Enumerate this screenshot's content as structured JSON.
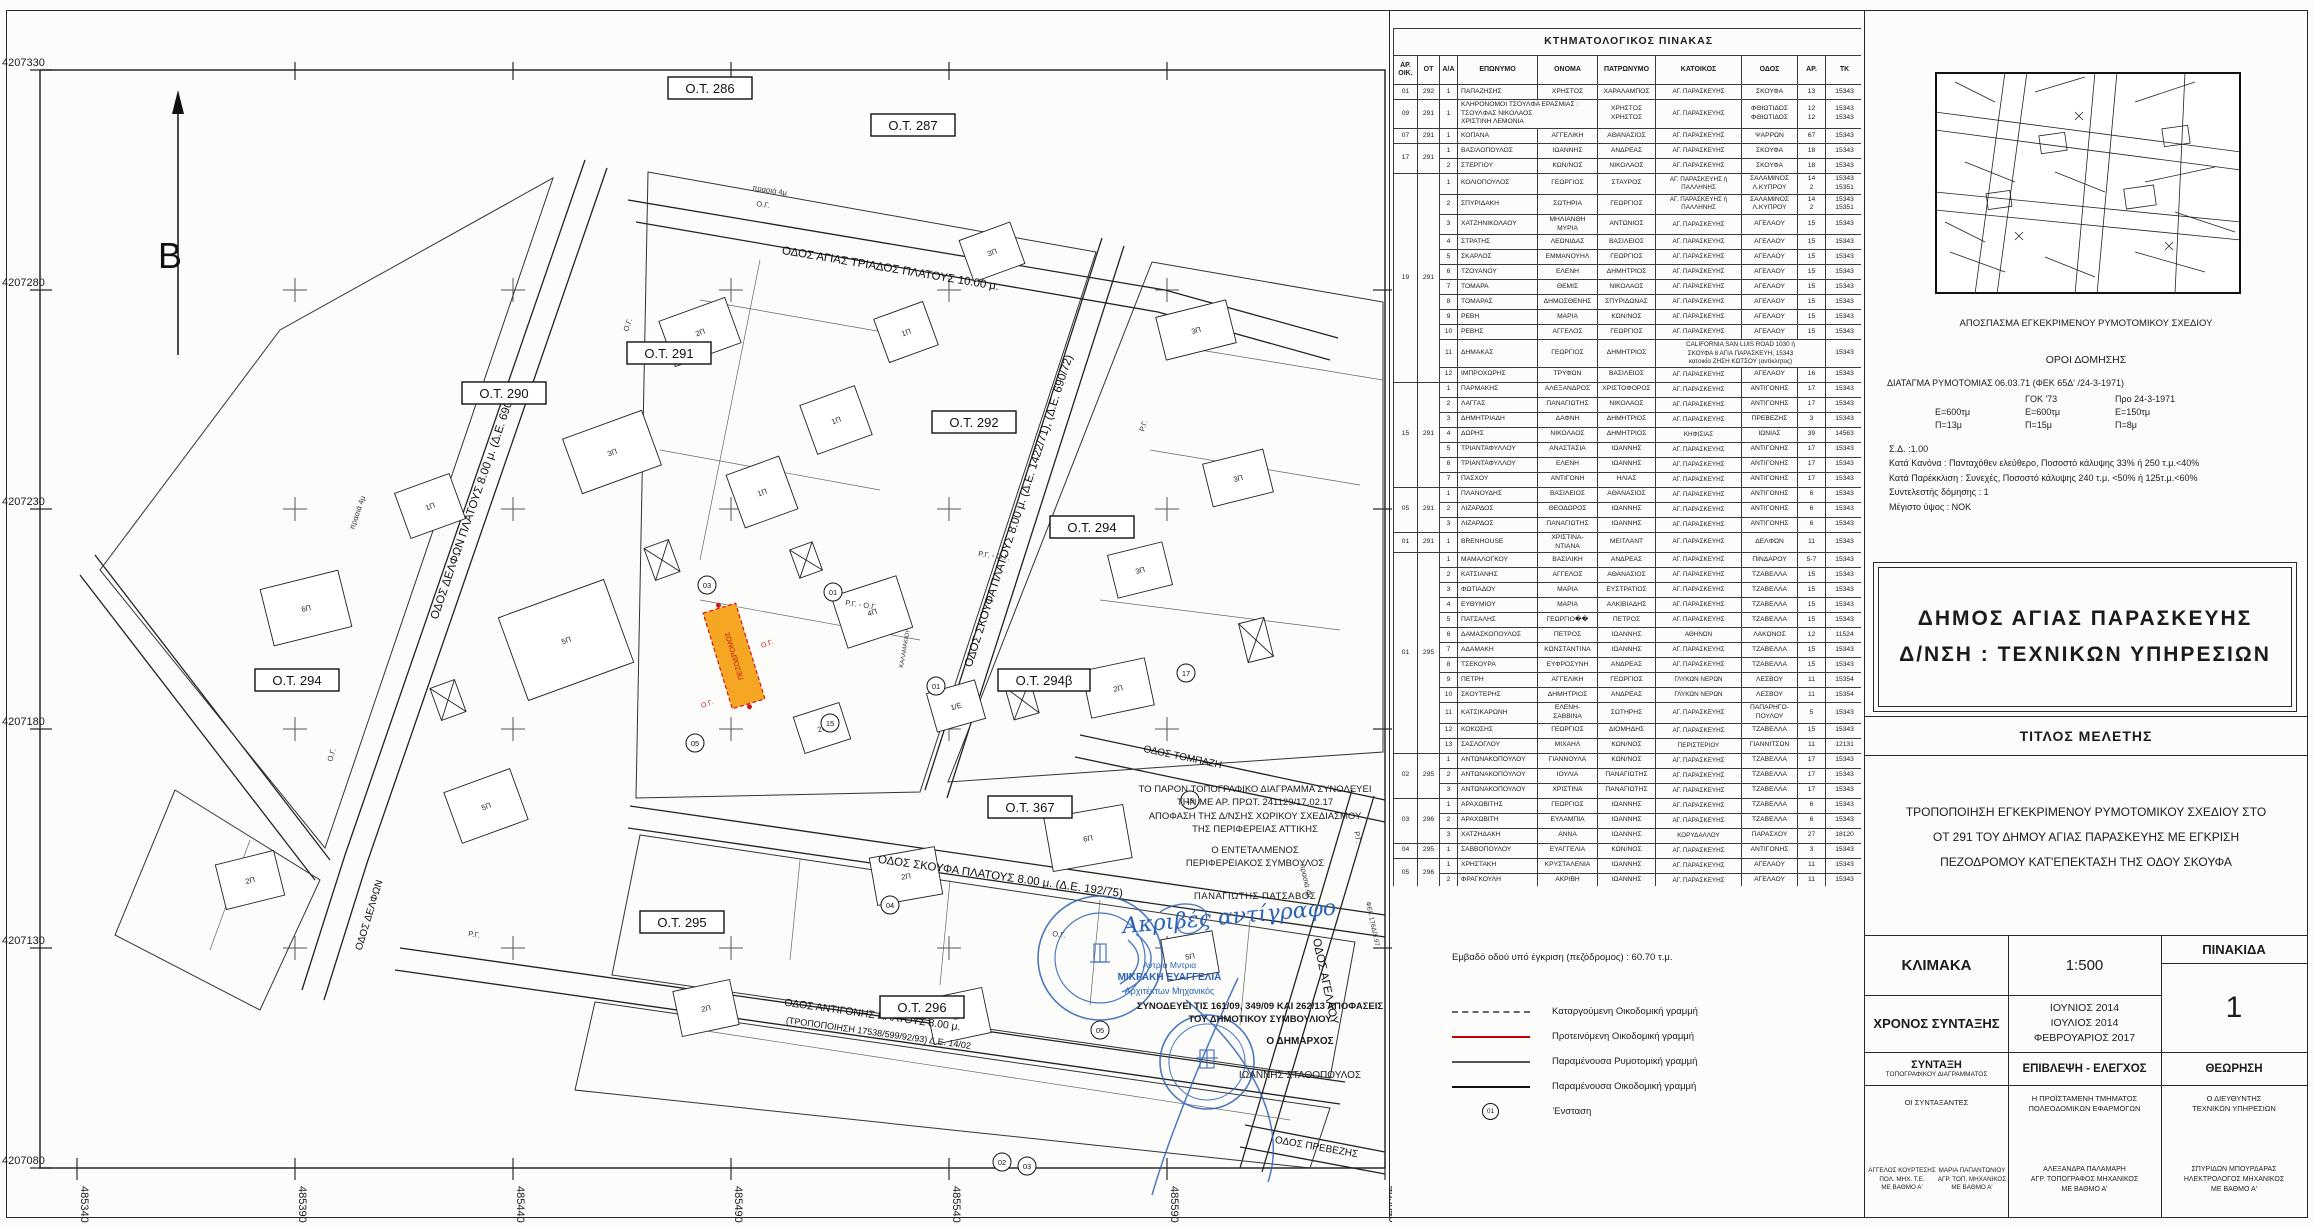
{
  "map": {
    "north_label": "Β",
    "y_ticks": [
      "4207330",
      "4207280",
      "4207230",
      "4207180",
      "4207130",
      "4207080"
    ],
    "x_ticks": [
      "485340",
      "485390",
      "485440",
      "485490",
      "485540",
      "485590",
      "485640"
    ],
    "blocks": [
      "Ο.Τ. 286",
      "Ο.Τ. 287",
      "Ο.Τ. 290",
      "Ο.Τ. 291",
      "Ο.Τ. 292",
      "Ο.Τ. 294",
      "Ο.Τ. 294β",
      "Ο.Τ. 367",
      "Ο.Τ. 294",
      "Ο.Τ. 295",
      "Ο.Τ. 296"
    ],
    "streets": [
      "ΟΔΟΣ ΑΓΙΑΣ ΤΡΙΑΔΟΣ ΠΛΑΤΟΥΣ 10.00 μ.",
      "ΟΔΟΣ ΔΕΛΦΩΝ ΠΛΑΤΟΥΣ 8.00 μ. (Δ.Ε. 690/72)",
      "ΟΔΟΣ ΣΚΟΥΦΑ ΠΛΑΤΟΥΣ 8.00 μ. (Δ.Ε. 1422/71), (Δ.Ε. 690/72)",
      "ΟΔΟΣ ΣΚΟΥΦΑ ΠΛΑΤΟΥΣ 8.00 μ. (Δ.Ε. 192/75)",
      "ΟΔΟΣ ΑΝΤΙΓΟΝΗΣ ΠΛΑΤΟΥΣ 8.00 μ.",
      "(ΤΡΟΠΟΠΟΙΗΣΗ 17538/599/92/93) Δ.Ε. 14/02",
      "ΟΔΟΣ ΑΓΕΛΑΟΥ",
      "ΟΔΟΣ ΠΡΕΒΕΖΗΣ",
      "ΟΔΟΣ ΤΟΜΠΑΖΗ",
      "ΟΔΟΣ ΔΕΛΦΩΝ"
    ],
    "pedestrian_label": "ΠΕΖΟΔΡΟΜΟΣ",
    "small": {
      "rg_og": "Ρ.Γ. - Ο.Γ.",
      "rg": "Ρ.Γ.",
      "og": "Ο.Γ.",
      "prasia": "πρασιά 4μ",
      "fek": "ΦΕΚ 176Δ/5.97",
      "kalamakiou": "ΚΑΛΑΜΑΚΙΟΥ"
    },
    "buildings": [
      "2Π",
      "3Π",
      "5Π",
      "1Π",
      "1Π",
      "1Π",
      "3Π",
      "3Π",
      "3Π",
      "3Π",
      "2Π",
      "4Π",
      "1/Ε",
      "2Π",
      "5Π",
      "6Π",
      "1Π",
      "2Π",
      "6Π",
      "2Π",
      "2Π",
      "5Π",
      "2Π"
    ],
    "objections": [
      "03",
      "01",
      "17",
      "15",
      "01",
      "05",
      "19",
      "04",
      "05",
      "02",
      "03"
    ]
  },
  "notes": {
    "line1": "ΤΟ ΠΑΡΟΝ ΤΟΠΟΓΡΑΦΙΚΟ ΔΙΑΓΡΑΜΜΑ ΣΥΝΟΔΕΥΕΙ\nΤΗΝ ΜΕ ΑΡ. ΠΡΩΤ. 241129/17.02.17\nΑΠΟΦΑΣΗ ΤΗΣ Δ/ΝΣΗΣ ΧΩΡΙΚΟΥ ΣΧΕΔΙΑΣΜΟΥ\nΤΗΣ ΠΕΡΙΦΕΡΕΙΑΣ ΑΤΤΙΚΗΣ",
    "line2": "Ο ΕΝΤΕΤΑΛΜΕΝΟΣ\nΠΕΡΙΦΕΡΕΙΑΚΟΣ ΣΥΜΒΟΥΛΟΣ",
    "name": "ΠΑΝΑΓΙΩΤΗΣ ΠΑΤΣΑΒΟΣ",
    "certified": "Ακριβές αντίγραφο",
    "architect_hand": "Αντρια Μντρια",
    "architect": "ΜΙΚΡΑΚΗ ΕΥΑΓΓΕΛΙΑ",
    "architect_title": "Αρχιτέκτων Μηχανικός",
    "council": "ΣΥΝΟΔΕΥΕΙ ΤΙΣ 161/09, 349/09 ΚΑΙ 262/13 ΑΠΟΦΑΣΕΙΣ\nΤΟΥ ΔΗΜΟΤΙΚΟΥ ΣΥΜΒΟΥΛΙΟΥ",
    "mayor_label": "Ο ΔΗΜΑΡΧΟΣ",
    "mayor": "ΙΩΑΝΝΗΣ ΣΤΑΘΟΠΟΥΛΟΣ"
  },
  "legend": {
    "area_note": "Εμβαδό οδού υπό έγκριση (πεζόδρομος) : 60.70 τ.μ.",
    "items": [
      {
        "label": "Καταργούμενη Οικοδομική γραμμή"
      },
      {
        "label": "Προτεινόμενη Οικοδομική γραμμή"
      },
      {
        "label": "Παραμένουσα Ρυμοτομική γραμμή"
      },
      {
        "label": "Παραμένουσα Οικοδομική γραμμή"
      }
    ],
    "objection_symbol": "01",
    "objection_label": "Ένσταση"
  },
  "table": {
    "title": "ΚΤΗΜΑΤΟΛΟΓΙΚΟΣ ΠΙΝΑΚΑΣ",
    "columns": [
      "ΑΡ.\nΟΙΚ.",
      "ΟΤ",
      "Α/Α",
      "ΕΠΩΝΥΜΟ",
      "ΟΝΟΜΑ",
      "ΠΑΤΡΩΝΥΜΟ",
      "ΚΑΤΟΙΚΟΣ",
      "ΟΔΟΣ",
      "ΑΡ.",
      "ΤΚ"
    ],
    "rows": [
      [
        "01",
        "292",
        "1",
        "ΠΑΠΑΖΗΣΗΣ",
        "ΧΡΗΣΤΟΣ",
        "ΧΑΡΑΛΑΜΠΟΣ",
        "ΑΓ. ΠΑΡΑΣΚΕΥΗΣ",
        "ΣΚΟΥΦΑ",
        "13",
        "15343"
      ],
      [
        "09",
        "291",
        "1",
        "ΚΛΗΡΟΝΟΜΟΙ ΤΣΟΥΛΦΑ ΕΡΑΣΜΙΑΣ :\nΤΣΟΥΛΦΑΣ ΝΙΚΟΛΑΟΣ\nΧΡΙΣΤΙΝΗ ΛΕΜΟΝΙΑ",
        "<",
        "ΧΡΗΣΤΟΣ\nΧΡΗΣΤΟΣ",
        "ΑΓ. ΠΑΡΑΣΚΕΥΗΣ",
        "ΦΘΙΩΤΙΔΟΣ\nΦΘΙΩΤΙΔΟΣ",
        "12\n12",
        "15343\n15343"
      ],
      [
        "07",
        "291",
        "1",
        "ΚΟΠΑΝΑ",
        "ΑΓΓΕΛΙΚΗ",
        "ΑΘΑΝΑΣΙΟΣ",
        "ΑΓ. ΠΑΡΑΣΚΕΥΗΣ",
        "ΨΑΡΡΩΝ",
        "67",
        "15343"
      ],
      [
        "17",
        "291",
        "1",
        "ΒΑΣΙΛΟΠΟΥΛΟΣ",
        "ΙΩΑΝΝΗΣ",
        "ΑΝΔΡΕΑΣ",
        "ΑΓ. ΠΑΡΑΣΚΕΥΗΣ",
        "ΣΚΟΥΦΑ",
        "18",
        "15343"
      ],
      [
        null,
        null,
        "2",
        "ΣΤΕΡΓΙΟΥ",
        "ΚΩΝ/ΝΟΣ",
        "ΝΙΚΟΛΑΟΣ",
        "ΑΓ. ΠΑΡΑΣΚΕΥΗΣ",
        "ΣΚΟΥΦΑ",
        "18",
        "15343"
      ],
      [
        "19",
        "291",
        "1",
        "ΚΟΛΙΟΠΟΥΛΟΣ",
        "ΓΕΩΡΓΙΟΣ",
        "ΣΤΑΥΡΟΣ",
        "ΑΓ. ΠΑΡΑΣΚΕΥΗΣ ή\nΠΑΛΛΗΝΗΣ",
        "ΣΑΛΑΜΙΝΟΣ\nΛ.ΚΥΠΡΟΥ",
        "14\n2",
        "15343\n15351"
      ],
      [
        null,
        null,
        "2",
        "ΣΠΥΡΙΔΑΚΗ",
        "ΣΩΤΗΡΙΑ",
        "ΓΕΩΡΓΙΟΣ",
        "ΑΓ. ΠΑΡΑΣΚΕΥΗΣ ή\nΠΑΛΛΗΝΗΣ",
        "ΣΑΛΑΜΙΝΟΣ\nΛ.ΚΥΠΡΟΥ",
        "14\n2",
        "15343\n15351"
      ],
      [
        null,
        null,
        "3",
        "ΧΑΤΖΗΝΙΚΟΛΑΟΥ",
        "ΜΗΛΙΑΝΘΗ\nΜΥΡΙΑ",
        "ΑΝΤΩΝΙΟΣ",
        "ΑΓ. ΠΑΡΑΣΚΕΥΗΣ",
        "ΑΓΕΛΑΟΥ",
        "15",
        "15343"
      ],
      [
        null,
        null,
        "4",
        "ΣΤΡΑΤΗΣ",
        "ΛΕΩΝΙΔΑΣ",
        "ΒΑΣΙΛΕΙΟΣ",
        "ΑΓ. ΠΑΡΑΣΚΕΥΗΣ",
        "ΑΓΕΛΑΟΥ",
        "15",
        "15343"
      ],
      [
        null,
        null,
        "5",
        "ΣΚΑΡΛΟΣ",
        "ΕΜΜΑΝΟΥΗΛ",
        "ΓΕΩΡΓΙΟΣ",
        "ΑΓ. ΠΑΡΑΣΚΕΥΗΣ",
        "ΑΓΕΛΑΟΥ",
        "15",
        "15343"
      ],
      [
        null,
        null,
        "6",
        "ΤΖΟΥΑΝΟΥ",
        "ΕΛΕΝΗ",
        "ΔΗΜΗΤΡΙΟΣ",
        "ΑΓ. ΠΑΡΑΣΚΕΥΗΣ",
        "ΑΓΕΛΑΟΥ",
        "15",
        "15343"
      ],
      [
        null,
        null,
        "7",
        "ΤΟΜΑΡΑ",
        "ΘΕΜΙΣ",
        "ΝΙΚΟΛΑΟΣ",
        "ΑΓ. ΠΑΡΑΣΚΕΥΗΣ",
        "ΑΓΕΛΑΟΥ",
        "15",
        "15343"
      ],
      [
        null,
        null,
        "8",
        "ΤΟΜΑΡΑΣ",
        "ΔΗΜΟΣΘΕΝΗΣ",
        "ΣΠΥΡΙΔΩΝΑΣ",
        "ΑΓ. ΠΑΡΑΣΚΕΥΗΣ",
        "ΑΓΕΛΑΟΥ",
        "15",
        "15343"
      ],
      [
        null,
        null,
        "9",
        "ΡΕΒΗ",
        "ΜΑΡΙΑ",
        "ΚΩΝ/ΝΟΣ",
        "ΑΓ. ΠΑΡΑΣΚΕΥΗΣ",
        "ΑΓΕΛΑΟΥ",
        "15",
        "15343"
      ],
      [
        null,
        null,
        "10",
        "ΡΕΒΗΣ",
        "ΑΓΓΕΛΟΣ",
        "ΓΕΩΡΓΙΟΣ",
        "ΑΓ. ΠΑΡΑΣΚΕΥΗΣ",
        "ΑΓΕΛΑΟΥ",
        "15",
        "15343"
      ],
      [
        null,
        null,
        "11",
        "ΔΗΜΑΚΑΣ",
        "ΓΕΩΡΓΙΟΣ",
        "ΔΗΜΗΤΡΙΟΣ",
        "CALIFORNIA   SAN LUIS ROAD   1030 ή\nΣΚΟΥΦΑ 8 ΑΓΙΑ ΠΑΡΑΣΚΕΥΗ, 15343\nκατοικία ΖΗΣΗ ΚΩΤΣΟΥ (αντίκλητος)",
        "<",
        "<",
        "15343"
      ],
      [
        null,
        null,
        "12",
        "ΙΜΠΡΟΧΩΡΗΣ",
        "ΤΡΥΦΩΝ",
        "ΒΑΣΙΛΕΙΟΣ",
        "ΑΓ. ΠΑΡΑΣΚΕΥΗΣ",
        "ΑΓΕΛΑΟΥ",
        "16",
        "15343"
      ],
      [
        "15",
        "291",
        "1",
        "ΠΑΡΜΑΚΗΣ",
        "ΑΛΕΞΑΝΔΡΟΣ",
        "ΧΡΙΣΤΟΦΟΡΟΣ",
        "ΑΓ. ΠΑΡΑΣΚΕΥΗΣ",
        "ΑΝΤΙΓΟΝΗΣ",
        "17",
        "15343"
      ],
      [
        null,
        null,
        "2",
        "ΛΑΓΓΑΣ",
        "ΠΑΝΑΓΙΩΤΗΣ",
        "ΝΙΚΟΛΑΟΣ",
        "ΑΓ. ΠΑΡΑΣΚΕΥΗΣ",
        "ΑΝΤΙΓΟΝΗΣ",
        "17",
        "15343"
      ],
      [
        null,
        null,
        "3",
        "ΔΗΜΗΤΡΙΑΔΗ",
        "ΔΑΦΝΗ",
        "ΔΗΜΗΤΡΙΟΣ",
        "ΑΓ. ΠΑΡΑΣΚΕΥΗΣ",
        "ΠΡΕΒΕΖΗΣ",
        "3",
        "15343"
      ],
      [
        null,
        null,
        "4",
        "ΔΩΡΗΣ",
        "ΝΙΚΟΛΑΟΣ",
        "ΔΗΜΗΤΡΙΟΣ",
        "ΚΗΦΙΣΙΑΣ",
        "ΙΩΝΙΑΣ",
        "39",
        "14563"
      ],
      [
        null,
        null,
        "5",
        "ΤΡΙΑΝΤΑΦΥΛΛΟΥ",
        "ΑΝΑΣΤΑΣΙΑ",
        "ΙΩΑΝΝΗΣ",
        "ΑΓ. ΠΑΡΑΣΚΕΥΗΣ",
        "ΑΝΤΙΓΟΝΗΣ",
        "17",
        "15343"
      ],
      [
        null,
        null,
        "6",
        "ΤΡΙΑΝΤΑΦΥΛΛΟΥ",
        "ΕΛΕΝΗ",
        "ΙΩΑΝΝΗΣ",
        "ΑΓ. ΠΑΡΑΣΚΕΥΗΣ",
        "ΑΝΤΙΓΟΝΗΣ",
        "17",
        "15343"
      ],
      [
        null,
        null,
        "7",
        "ΠΑΣΧΟΥ",
        "ΑΝΤΙΓΟΝΗ",
        "ΗΛΙΑΣ",
        "ΑΓ. ΠΑΡΑΣΚΕΥΗΣ",
        "ΑΝΤΙΓΟΝΗΣ",
        "17",
        "15343"
      ],
      [
        "05",
        "291",
        "1",
        "ΠΛΑΝΟΥΔΗΣ",
        "ΒΑΣΙΛΕΙΟΣ",
        "ΑΘΑΝΑΣΙΟΣ",
        "ΑΓ. ΠΑΡΑΣΚΕΥΗΣ",
        "ΑΝΤΙΓΟΝΗΣ",
        "6",
        "15343"
      ],
      [
        null,
        null,
        "2",
        "ΛΙΖΑΡΔΟΣ",
        "ΘΕΟΔΩΡΟΣ",
        "ΙΩΑΝΝΗΣ",
        "ΑΓ. ΠΑΡΑΣΚΕΥΗΣ",
        "ΑΝΤΙΓΟΝΗΣ",
        "6",
        "15343"
      ],
      [
        null,
        null,
        "3",
        "ΛΙΖΑΡΔΟΣ",
        "ΠΑΝΑΓΙΩΤΗΣ",
        "ΙΩΑΝΝΗΣ",
        "ΑΓ. ΠΑΡΑΣΚΕΥΗΣ",
        "ΑΝΤΙΓΟΝΗΣ",
        "6",
        "15343"
      ],
      [
        "01",
        "291",
        "1",
        "BRENHOUSE",
        "ΧΡΙΣΤΙΝΑ-ΝΤΙΑΝΑ",
        "ΜΕΙΤΛΑΝΤ",
        "ΑΓ. ΠΑΡΑΣΚΕΥΗΣ",
        "ΔΕΛΦΩΝ",
        "11",
        "15343"
      ],
      [
        "01",
        "295",
        "1",
        "ΜΑΜΑΛΟΓΚΟΥ",
        "ΒΑΣΙΛΙΚΗ",
        "ΑΝΔΡΕΑΣ",
        "ΑΓ. ΠΑΡΑΣΚΕΥΗΣ",
        "ΠΙΝΔΑΡΟΥ",
        "5-7",
        "15343"
      ],
      [
        null,
        null,
        "2",
        "ΚΑΤΣΙΑΝΗΣ",
        "ΑΓΓΕΛΟΣ",
        "ΑΘΑΝΑΣΙΟΣ",
        "ΑΓ. ΠΑΡΑΣΚΕΥΗΣ",
        "ΤΖΑΒΕΛΛΑ",
        "15",
        "15343"
      ],
      [
        null,
        null,
        "3",
        "ΦΩΤΙΑΔΟΥ",
        "ΜΑΡΙΑ",
        "ΕΥΣΤΡΑΤΙΟΣ",
        "ΑΓ. ΠΑΡΑΣΚΕΥΗΣ",
        "ΤΖΑΒΕΛΛΑ",
        "15",
        "15343"
      ],
      [
        null,
        null,
        "4",
        "ΕΥΘΥΜΙΟΥ",
        "ΜΑΡΙΑ",
        "ΑΛΚΙΒΙΑΔΗΣ",
        "ΑΓ. ΠΑΡΑΣΚΕΥΗΣ",
        "ΤΖΑΒΕΛΛΑ",
        "15",
        "15343"
      ],
      [
        null,
        null,
        "5",
        "ΠΑΤΣΑΛΗΣ",
        "ΓΕΩΡΓΙΟ��",
        "ΠΕΤΡΟΣ",
        "ΑΓ. ΠΑΡΑΣΚΕΥΗΣ",
        "ΤΖΑΒΕΛΛΑ",
        "15",
        "15343"
      ],
      [
        null,
        null,
        "6",
        "ΔΑΜΑΣΚΟΠΟΥΛΟΣ",
        "ΠΕΤΡΟΣ",
        "ΙΩΑΝΝΗΣ",
        "ΑΘΗΝΩΝ",
        "ΛΑΚΩΝΟΣ",
        "12",
        "11524"
      ],
      [
        null,
        null,
        "7",
        "ΑΔΑΜΑΚΗ",
        "ΚΩΝΣΤΑΝΤΙΝΑ",
        "ΙΩΑΝΝΗΣ",
        "ΑΓ. ΠΑΡΑΣΚΕΥΗΣ",
        "ΤΖΑΒΕΛΛΑ",
        "15",
        "15343"
      ],
      [
        null,
        null,
        "8",
        "ΤΣΕΚΟΥΡΑ",
        "ΕΥΦΡΟΣΥΝΗ",
        "ΑΝΔΡΕΑΣ",
        "ΑΓ. ΠΑΡΑΣΚΕΥΗΣ",
        "ΤΖΑΒΕΛΛΑ",
        "15",
        "15343"
      ],
      [
        null,
        null,
        "9",
        "ΠΕΤΡΗ",
        "ΑΓΓΕΛΙΚΗ",
        "ΓΕΩΡΓΙΟΣ",
        "ΓΛΥΚΩΝ ΝΕΡΩΝ",
        "ΛΕΣΒΟΥ",
        "11",
        "15354"
      ],
      [
        null,
        null,
        "10",
        "ΣΚΟΥΤΕΡΗΣ",
        "ΔΗΜΗΤΡΙΟΣ",
        "ΑΝΔΡΕΑΣ",
        "ΓΛΥΚΩΝ ΝΕΡΩΝ",
        "ΛΕΣΒΟΥ",
        "11",
        "15354"
      ],
      [
        null,
        null,
        "11",
        "ΚΑΤΣΙΚΑΡΩΝΗ",
        "ΕΛΕΝΗ-\nΣΑΒΒΙΝΑ",
        "ΣΩΤΗΡΗΣ",
        "ΑΓ. ΠΑΡΑΣΚΕΥΗΣ",
        "ΠΑΠΑΡΗΓΟ-\nΠΟΥΛΟΥ",
        "5",
        "15343"
      ],
      [
        null,
        null,
        "12",
        "ΚΟΚΟΣΗΣ",
        "ΓΕΩΡΓΙΟΣ",
        "ΔΙΟΜΗΔΗΣ",
        "ΑΓ. ΠΑΡΑΣΚΕΥΗΣ",
        "ΤΖΑΒΕΛΛΑ",
        "15",
        "15343"
      ],
      [
        null,
        null,
        "13",
        "ΣΑΣΛΟΓΛΟΥ",
        "ΜΙΧΑΗΛ",
        "ΚΩΝ/ΝΟΣ",
        "ΠΕΡΙΣΤΕΡΙΟΥ",
        "ΓΙΑΝΝΙΤΣΩΝ",
        "11",
        "12131"
      ],
      [
        "02",
        "295",
        "1",
        "ΑΝΤΩΝΑΚΟΠΟΥΛΟΥ",
        "ΓΙΑΝΝΟΥΛΑ",
        "ΚΩΝ/ΝΟΣ",
        "ΑΓ. ΠΑΡΑΣΚΕΥΗΣ",
        "ΤΖΑΒΕΛΛΑ",
        "17",
        "15343"
      ],
      [
        null,
        null,
        "2",
        "ΑΝΤΩΝΑΚΟΠΟΥΛΟΥ",
        "ΙΟΥΛΙΑ",
        "ΠΑΝΑΓΙΩΤΗΣ",
        "ΑΓ. ΠΑΡΑΣΚΕΥΗΣ",
        "ΤΖΑΒΕΛΛΑ",
        "17",
        "15343"
      ],
      [
        null,
        null,
        "3",
        "ΑΝΤΩΝΑΚΟΠΟΥΛΟΥ",
        "ΧΡΙΣΤΙΝΑ",
        "ΠΑΝΑΓΙΩΤΗΣ",
        "ΑΓ. ΠΑΡΑΣΚΕΥΗΣ",
        "ΤΖΑΒΕΛΛΑ",
        "17",
        "15343"
      ],
      [
        "03",
        "296",
        "1",
        "ΑΡΑΧΩΒΙΤΗΣ",
        "ΓΕΩΡΓΙΟΣ",
        "ΙΩΑΝΝΗΣ",
        "ΑΓ. ΠΑΡΑΣΚΕΥΗΣ",
        "ΤΖΑΒΕΛΛΑ",
        "6",
        "15343"
      ],
      [
        null,
        null,
        "2",
        "ΑΡΑΧΩΒΙΤΗ",
        "ΕΥΛΑΜΠΙΑ",
        "ΙΩΑΝΝΗΣ",
        "ΑΓ. ΠΑΡΑΣΚΕΥΗΣ",
        "ΤΖΑΒΕΛΛΑ",
        "6",
        "15343"
      ],
      [
        null,
        null,
        "3",
        "ΧΑΤΖΗΔΑΚΗ",
        "ΑΝΝΑ",
        "ΙΩΑΝΝΗΣ",
        "ΚΟΡΥΔΑΛΛΟΥ",
        "ΠΑΡΑΣΧΟΥ",
        "27",
        "18120"
      ],
      [
        "04",
        "295",
        "1",
        "ΣΑΒΒΟΠΟΥΛΟΥ",
        "ΕΥΑΓΓΕΛΙΑ",
        "ΚΩΝ/ΝΟΣ",
        "ΑΓ. ΠΑΡΑΣΚΕΥΗΣ",
        "ΑΝΤΙΓΟΝΗΣ",
        "3",
        "15343"
      ],
      [
        "05",
        "296",
        "1",
        "ΧΡΗΣΤΑΚΗ",
        "ΚΡΥΣΤΑΛΕΝΙΑ",
        "ΙΩΑΝΝΗΣ",
        "ΑΓ. ΠΑΡΑΣΚΕΥΗΣ",
        "ΑΓΕΛΑΟΥ",
        "11",
        "15343"
      ],
      [
        null,
        null,
        "2",
        "ΦΡΑΓΚΟΥΛΗ",
        "ΑΚΡΙΒΗ",
        "ΙΩΑΝΝΗΣ",
        "ΑΓ. ΠΑΡΑΣΚΕΥΗΣ",
        "ΑΓΕΛΑΟΥ",
        "11",
        "15343"
      ]
    ]
  },
  "panel": {
    "excerpt_caption": "ΑΠΟΣΠΑΣΜΑ ΕΓΚΕΚΡΙΜΕΝΟΥ ΡΥΜΟΤΟΜΙΚΟΥ ΣΧΕΔΙΟΥ",
    "terms_title": "ΟΡΟΙ ΔΟΜΗΣΗΣ",
    "decree": "ΔΙΑΤΑΓΜΑ ΡΥΜΟΤΟΜΙΑΣ 06.03.71 (ΦΕΚ 65Δ' /24-3-1971)",
    "gok_header": "ΓΟΚ '73",
    "pre_header": "Προ 24-3-1971",
    "e_row": [
      "Ε=600τμ",
      "Ε=600τμ",
      "Ε=150τμ"
    ],
    "p_row": [
      "Π=13μ",
      "Π=15μ",
      "Π=8μ"
    ],
    "sd": "Σ.Δ. :1.00",
    "rule": "Κατά Κανόνα : Πανταχόθεν ελεύθερο, Ποσοστό κάλυψης 33% ή 250 τ.μ.<40%",
    "exception": "Κατά Παρέκκλιση : Συνεχές, Ποσοστό κάλυψης 240 τ.μ. <50% ή 125τ.μ.<60%",
    "coefficient": "Συντελεστής δόμησης : 1",
    "max_height": "Μέγιστο ύψος : ΝΟΚ",
    "municipality": "ΔΗΜΟΣ  ΑΓΙΑΣ  ΠΑΡΑΣΚΕΥΗΣ",
    "department": "Δ/ΝΣΗ : ΤΕΧΝΙΚΩΝ ΥΠΗΡΕΣΙΩΝ",
    "study_title_label": "ΤΙΤΛΟΣ ΜΕΛΕΤΗΣ",
    "study_title": "ΤΡΟΠΟΠΟΙΗΣΗ ΕΓΚΕΚΡΙΜΕΝΟΥ ΡΥΜΟΤΟΜΙΚΟΥ ΣΧΕΔΙΟΥ  ΣΤΟ\nΟΤ 291 ΤΟΥ ΔΗΜΟΥ ΑΓΙΑΣ ΠΑΡΑΣΚΕΥΗΣ  ΜΕ ΕΓΚΡΙΣΗ\nΠΕΖΟΔΡΟΜΟΥ ΚΑΤ'ΕΠΕΚΤΑΣΗ ΤΗΣ ΟΔΟΥ ΣΚΟΥΦΑ",
    "scale_label": "ΚΛΙΜΑΚΑ",
    "scale_value": "1:500",
    "plate_label": "ΠΙΝΑΚΙΔΑ",
    "plate_value": "1",
    "date_label": "ΧΡΟΝΟΣ ΣΥΝΤΑΞΗΣ",
    "dates": "ΙΟΥΝΙΟΣ 2014\nΙΟΥΛΙΟΣ 2014\nΦΕΒΡΟΥΑΡΙΟΣ 2017",
    "col_compile": "ΣΥΝΤΑΞΗ",
    "col_compile_sub": "ΤΟΠΟΓΡΑΦΙΚΟΥ ΔΙΑΓΡΑΜΜΑΤΟΣ",
    "col_supervision": "ΕΠΙΒΛΕΨΗ - ΕΛΕΓΧΟΣ",
    "col_approval": "ΘΕΩΡΗΣΗ",
    "role_compilers": "ΟΙ ΣΥΝΤΑΞΑΝΤΕΣ",
    "role_supervisor": "Η ΠΡΟΪΣΤΑΜΕΝΗ ΤΜΗΜΑΤΟΣ\nΠΟΛΕΟΔΟΜΙΚΩΝ ΕΦΑΡΜΟΓΩΝ",
    "role_director": "Ο ΔΙΕΥΘΥΝΤΗΣ\nΤΕΧΝΙΚΩΝ ΥΠΗΡΕΣΙΩΝ",
    "name1": "ΑΓΓΕΛΟΣ ΚΟΥΡΤΕΣΗΣ\nΠΟΛ. ΜΗΧ. Τ.Ε.\nΜΕ ΒΑΘΜΟ Α'",
    "name2": "ΜΑΡΙΑ ΠΑΠΑΝΤΩΝΙΟΥ\nΑΓΡ. ΤΟΠ. ΜΗΧΑΝΙΚΟΣ\nΜΕ ΒΑΘΜΟ Α'",
    "name3": "ΑΛΕΞΑΝΔΡΑ ΠΑΛΑΜΑΡΗ\nΑΓΡ. ΤΟΠΟΓΡΑΦΟΣ ΜΗΧΑΝΙΚΟΣ\nΜΕ ΒΑΘΜΟ Α'",
    "name4": "ΣΠΥΡΙΔΩΝ ΜΠΟΥΡΔΑΡΑΣ\nΗΛΕΚΤΡΟΛΟΓΟΣ ΜΗΧΑΝΙΚΟΣ\nΜΕ ΒΑΘΜΟ Α'"
  }
}
